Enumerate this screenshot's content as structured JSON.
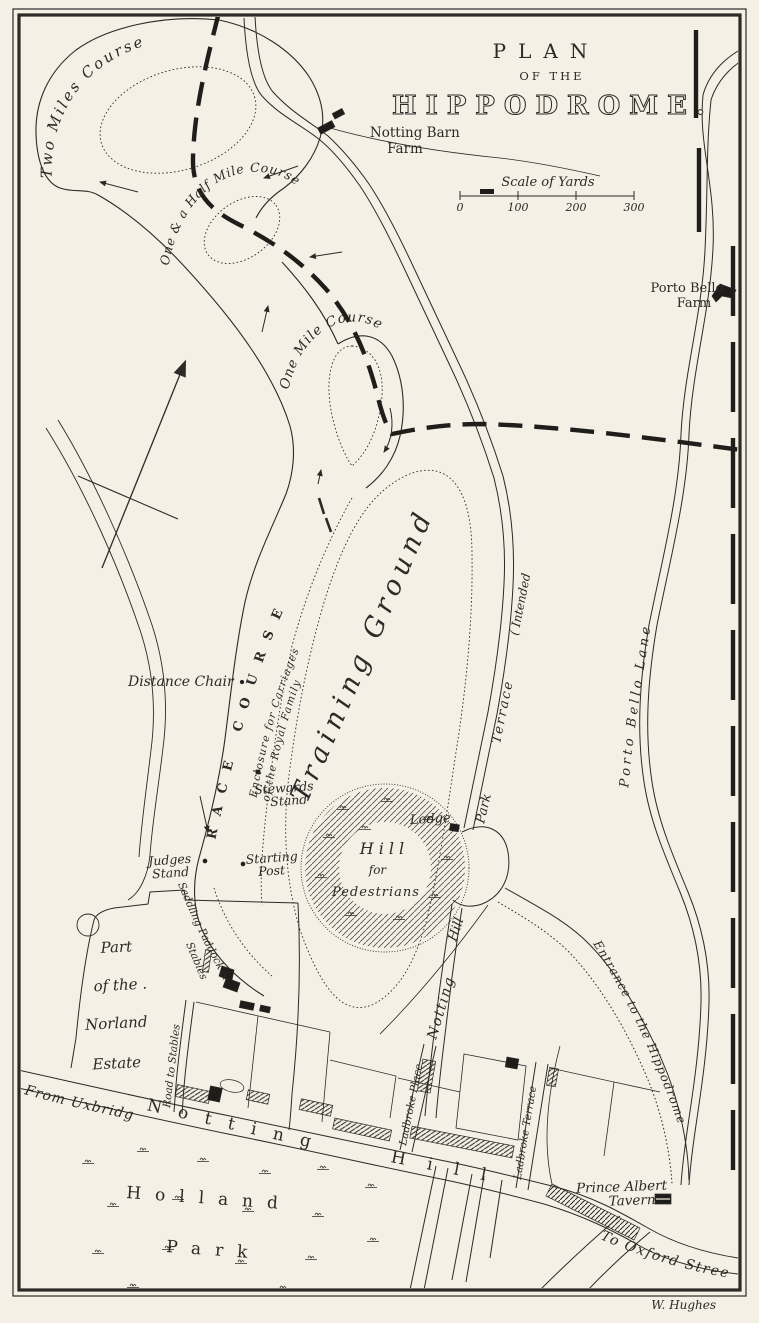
{
  "title": {
    "plan": "PLAN",
    "of_the": "OF THE",
    "hippodrome": "HIPPODROME."
  },
  "scale_bar": {
    "label": "Scale of Yards",
    "ticks": [
      "0",
      "100",
      "200",
      "300"
    ]
  },
  "courses": {
    "two_miles": "Two Miles Course",
    "one_and_half": "One & a Half Mile Course",
    "one_mile": "One Mile Course",
    "race_course": "RACE COURSE"
  },
  "grounds": {
    "training_ground": "Training Ground",
    "hill_line1": "Hill",
    "hill_line2": "for",
    "hill_line3": "Pedestrians",
    "enclosure_line1": "Enclosure for Carriages",
    "enclosure_line2": "of the Royal Family"
  },
  "stations": {
    "distance_chair": "Distance Chair",
    "stewards_line1": "Stewards",
    "stewards_line2": "Stand",
    "judges_line1": "Judges",
    "judges_line2": "Stand",
    "starting_line1": "Starting",
    "starting_line2": "Post",
    "lodge": "Lodge"
  },
  "places": {
    "notting_barn_line1": "Notting Barn",
    "notting_barn_line2": "Farm",
    "porto_bello_farm_line1": "Porto Bello",
    "porto_bello_farm_line2": "Farm",
    "norland_line1": "Part",
    "norland_line2": "of the .",
    "norland_line3": "Norland",
    "norland_line4": "Estate",
    "holland": "Holland",
    "holland_park": "Park",
    "prince_albert_line1": "Prince Albert",
    "prince_albert_line2": "Tavern"
  },
  "roads": {
    "porto_bello_lane": "Porto Bello Lane",
    "park": "Park",
    "terrace": "Terrace",
    "intended": "( Intended",
    "notting_road": "Notting",
    "hill_road": "Hill",
    "entrance": "Entrance to the Hippodrome",
    "saddling_line1": "Saddling Paddock &",
    "saddling_line2": "Stables",
    "road_to_stables": "Road to Stables",
    "from_uxbridge": "From Uxbridge",
    "notting_street": "Notting",
    "hill_street": "Hill",
    "ladbroke_place": "Ladbroke Place",
    "ladbroke_terrace": "Ladbroke Terrace",
    "to_oxford_street": "To Oxford Street"
  },
  "credits": {
    "engraver": "W. Hughes"
  },
  "colors": {
    "paper": "#f4f0e6",
    "ink": "#2b2a26"
  }
}
